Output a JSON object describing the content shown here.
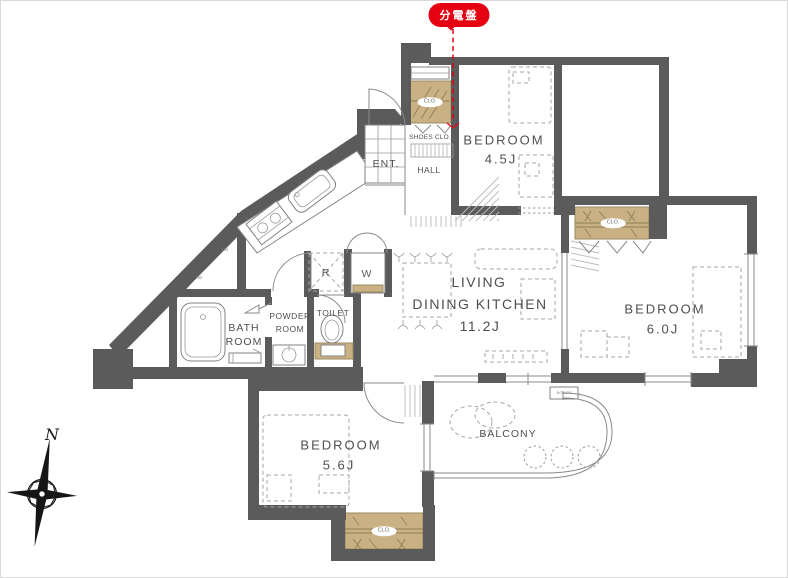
{
  "badge": {
    "label": "分電盤"
  },
  "compass": {
    "north": "N"
  },
  "rooms": {
    "bedroom_top": {
      "name": "BEDROOM",
      "size": "4.5J"
    },
    "bedroom_right": {
      "name": "BEDROOM",
      "size": "6.0J"
    },
    "bedroom_bottom": {
      "name": "BEDROOM",
      "size": "5.6J"
    },
    "ldk": {
      "line1": "LIVING",
      "line2": "DINING KITCHEN",
      "size": "11.2J"
    },
    "bath": {
      "line1": "BATH",
      "line2": "ROOM"
    },
    "powder": {
      "line1": "POWDER",
      "line2": "ROOM"
    },
    "toilet": {
      "name": "TOILET"
    },
    "entrance": {
      "name": "ENT."
    },
    "hall": {
      "name": "HALL"
    },
    "shoes_closet": {
      "name": "SHOES CLO."
    },
    "balcony": {
      "name": "BALCONY"
    }
  },
  "labels": {
    "closet": "CLO.",
    "refrigerator": "R",
    "washer": "W",
    "boiler": "BOILER",
    "shaft": "UB"
  },
  "colors": {
    "wall": "#5b5b5b",
    "closet": "#c9b183",
    "red": "#e50012",
    "line": "#8a8a8a",
    "text": "#4f4f4f"
  }
}
